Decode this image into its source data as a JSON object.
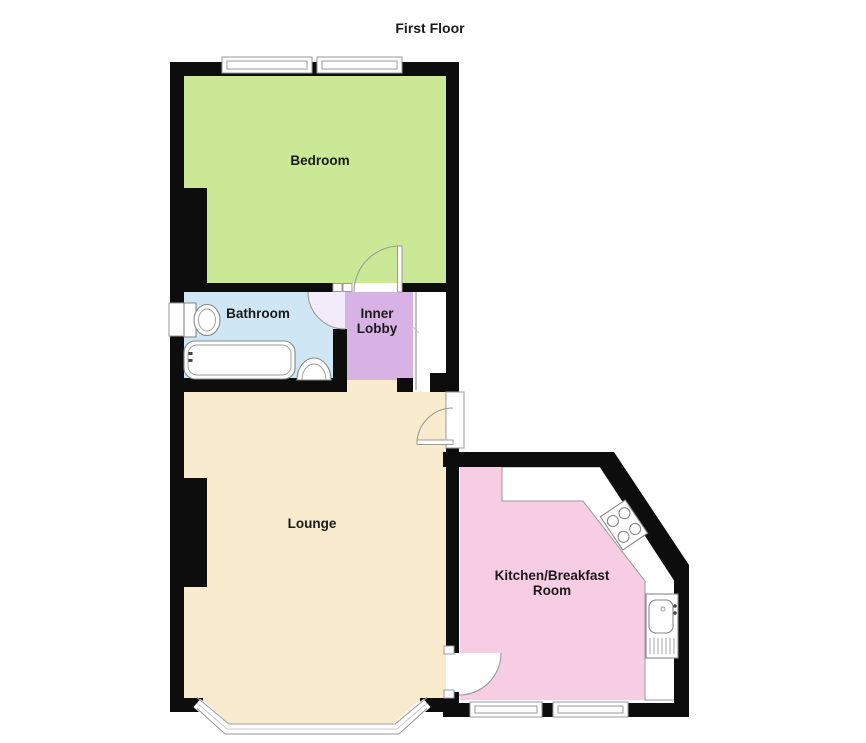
{
  "title": "First Floor",
  "colors": {
    "bedroom": "#cbe897",
    "bathroom": "#cfe7f5",
    "inner_lobby": "#d8b2e4",
    "lounge": "#f9ebcd",
    "kitchen": "#f7cde4",
    "wall": "#0d0d0d",
    "door_swing_tint": "#f3ebf9",
    "window_fill": "#ffffff",
    "fixture_outline": "#888888"
  },
  "rooms": {
    "bedroom": {
      "label": "Bedroom"
    },
    "bathroom": {
      "label": "Bathroom"
    },
    "inner_lobby": {
      "line1": "Inner",
      "line2": "Lobby"
    },
    "lounge": {
      "label": "Lounge"
    },
    "kitchen": {
      "line1": "Kitchen/Breakfast",
      "line2": "Room"
    }
  },
  "fixtures": {
    "bathroom": [
      "toilet",
      "bathtub",
      "basin"
    ],
    "kitchen": [
      "hob",
      "sink-unit"
    ]
  },
  "windows": {
    "bedroom_top": 2,
    "bathroom_side": 1,
    "kitchen_bottom": 2,
    "lounge_bay": 1
  },
  "doors": [
    "bedroom-door",
    "bathroom-door",
    "entry-door",
    "kitchen-door"
  ]
}
